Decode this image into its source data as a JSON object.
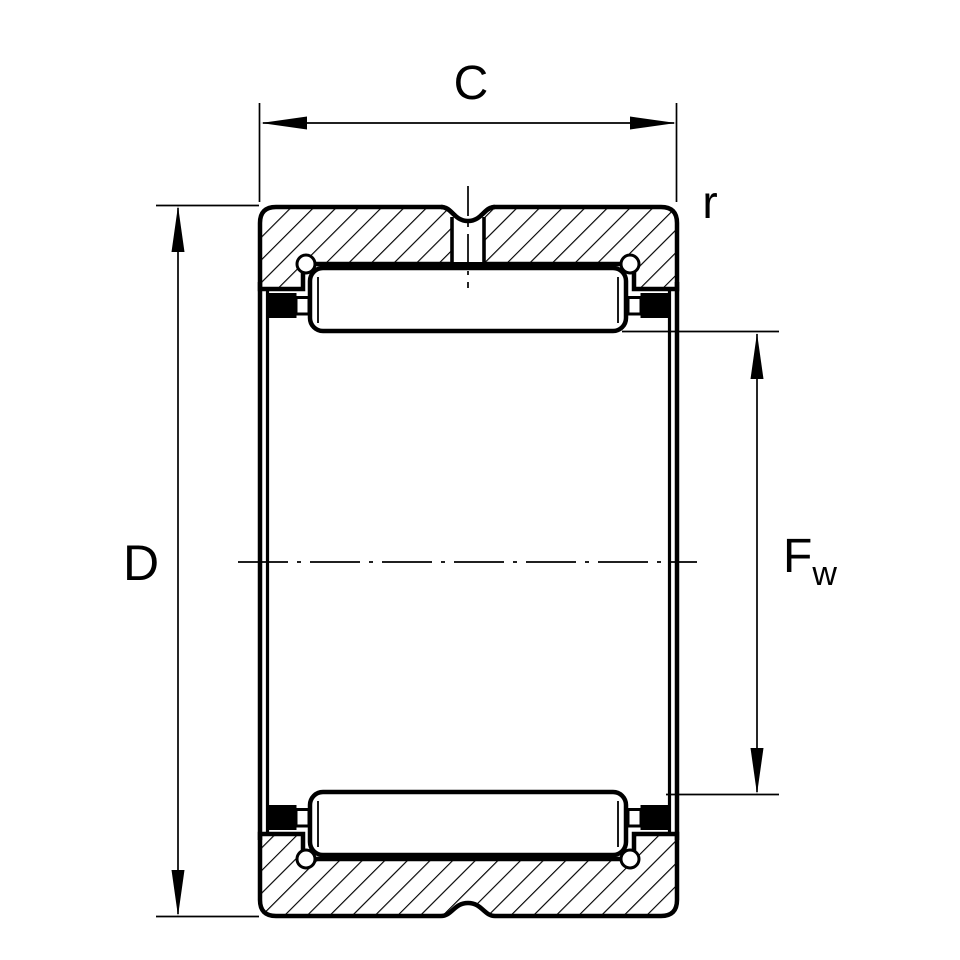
{
  "diagram": {
    "kind": "technical-drawing",
    "subject": "needle-roller-bearing-cross-section",
    "labels": {
      "width_dimension": "C",
      "outer_diameter_dimension": "D",
      "corner_radius": "r",
      "bore_diameter_letter": "F",
      "bore_diameter_subscript": "w"
    },
    "colors": {
      "background": "#ffffff",
      "line": "#000000",
      "fill": "#ffffff"
    }
  }
}
